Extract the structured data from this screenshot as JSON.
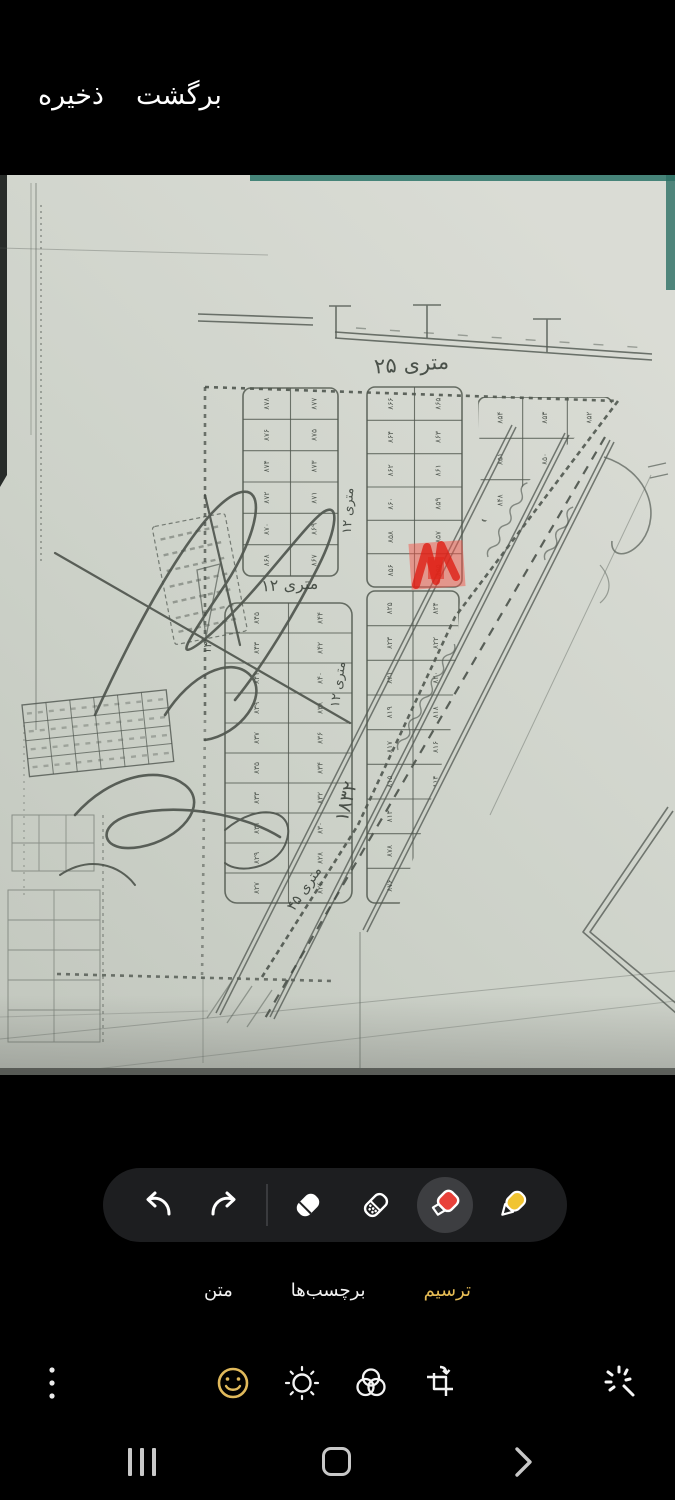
{
  "top_bar": {
    "back_label": "برگشت",
    "save_label": "ذخیره"
  },
  "tabs": {
    "draw": "ترسیم",
    "stickers": "برچسب‌ها",
    "text": "متن",
    "selected": "ترسیم",
    "selected_color": "#e6bc55"
  },
  "tools": {
    "selected_tool": "highlighter",
    "highlighter_color": "#e8413a",
    "pen_color": "#f1c431",
    "toolbar_bg": "#1d1e20"
  },
  "bottom_icons": [
    "more-menu",
    "emoji",
    "tone",
    "filters",
    "transform",
    "spot-fix"
  ],
  "nav_bar": [
    "recents",
    "home",
    "back"
  ],
  "map": {
    "street_labels": [
      {
        "text": "۲۵ متری",
        "x": 412,
        "y": 196,
        "rot": -4,
        "size": 21
      },
      {
        "text": "۱۲ متری",
        "x": 352,
        "y": 336,
        "rot": -87,
        "size": 13
      },
      {
        "text": "۱۲ متری",
        "x": 290,
        "y": 415,
        "rot": -3,
        "size": 16
      },
      {
        "text": "۱۲ متری",
        "x": 342,
        "y": 510,
        "rot": -82,
        "size": 13
      },
      {
        "text": "۱۸۳۲",
        "x": 352,
        "y": 628,
        "rot": -76,
        "size": 19
      },
      {
        "text": "۴۵ متری",
        "x": 308,
        "y": 716,
        "rot": -56,
        "size": 14
      },
      {
        "text": "۱۴",
        "x": 211,
        "y": 473,
        "rot": -85,
        "size": 11
      }
    ],
    "plot_numbers": [
      "۸۷۸",
      "۸۷۷",
      "۸۷۶",
      "۸۷۵",
      "۸۷۴",
      "۸۷۳",
      "۸۷۲",
      "۸۷۱",
      "۸۷۰",
      "۸۶۹",
      "۸۶۸",
      "۸۶۷",
      "۸۶۶",
      "۸۶۵",
      "۸۶۴",
      "۸۶۳",
      "۸۶۲",
      "۸۶۱",
      "۸۶۰",
      "۸۵۹",
      "۸۵۸",
      "۸۵۷",
      "۸۵۶",
      "۸۵۵",
      "۸۵۴",
      "۸۵۳",
      "۸۵۲",
      "۸۵۱",
      "۸۵۰",
      "۸۴۹",
      "۸۴۸",
      "۸۴۷",
      "۸۴۶",
      "۸۴۵",
      "۸۴۴",
      "۸۴۳",
      "۸۴۲",
      "۸۴۱",
      "۸۴۰",
      "۸۳۹",
      "۸۳۸",
      "۸۳۷",
      "۸۳۶",
      "۸۳۵",
      "۸۳۴",
      "۸۳۳",
      "۸۳۲",
      "۸۳۱",
      "۸۳۰",
      "۸۲۹",
      "۸۲۸",
      "۸۲۷",
      "۸۲۶",
      "۸۲۵",
      "۸۲۴",
      "۸۲۳",
      "۸۲۲",
      "۸۲۱",
      "۸۲۰",
      "۸۱۹",
      "۸۱۸",
      "۸۱۷",
      "۸۱۶",
      "۸۱۵",
      "۸۱۴",
      "۸۱۳",
      "۸۱۲"
    ],
    "blocks": [
      {
        "id": "block-a",
        "x": 243,
        "y": 213,
        "w": 95,
        "h": 188,
        "rows": 6,
        "cols": 2,
        "rx": 8
      },
      {
        "id": "block-b",
        "x": 367,
        "y": 212,
        "w": 95,
        "h": 200,
        "rows": 6,
        "cols": 2,
        "rx": 8
      },
      {
        "id": "block-c",
        "x": 478,
        "y": 222,
        "w": 134,
        "h": 124,
        "rows": 3,
        "cols": 3,
        "rx": 8,
        "clip": "clipC"
      },
      {
        "id": "block-d",
        "x": 225,
        "y": 428,
        "w": 127,
        "h": 300,
        "rows": 10,
        "cols": 2,
        "rx": 12
      },
      {
        "id": "block-e",
        "x": 367,
        "y": 416,
        "w": 92,
        "h": 312,
        "rows": 9,
        "cols": 2,
        "rx": 8,
        "clip": "clipE"
      }
    ],
    "highlight_annotation": {
      "color": "#e8271e",
      "note": "red highlighter scribble on plot"
    }
  }
}
